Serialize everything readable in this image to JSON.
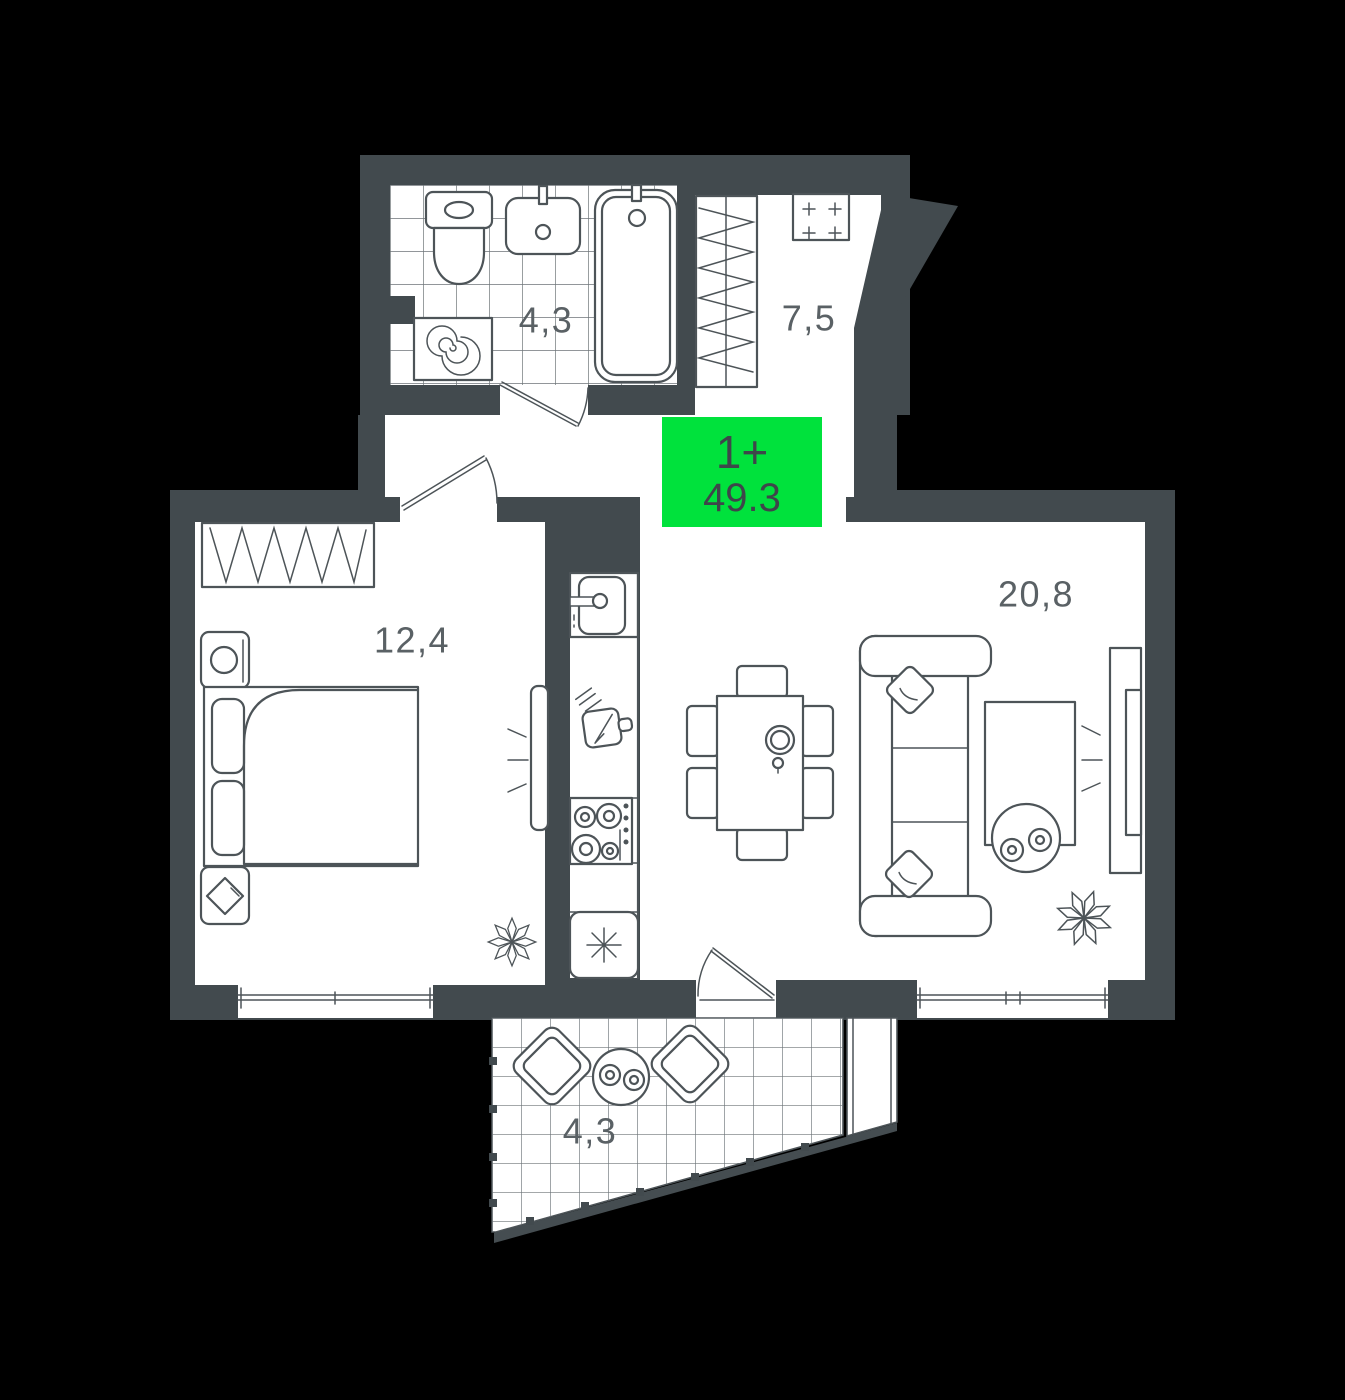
{
  "plan": {
    "badge": {
      "rooms_label": "1+",
      "area_value": "49.3"
    },
    "rooms": [
      {
        "id": "bathroom",
        "area_label": "4,3"
      },
      {
        "id": "hallway",
        "area_label": "7,5"
      },
      {
        "id": "bedroom",
        "area_label": "12,4"
      },
      {
        "id": "living-room",
        "area_label": "20,8"
      },
      {
        "id": "balcony",
        "area_label": "4,3"
      }
    ],
    "colors": {
      "background": "#000000",
      "wall": "#424a4e",
      "room": "#ffffff",
      "line": "#4d5458",
      "tile_line": "#6d7478",
      "label": "#5a6165",
      "badge_bg": "#00e23c",
      "badge_text": "#3e464a"
    }
  }
}
